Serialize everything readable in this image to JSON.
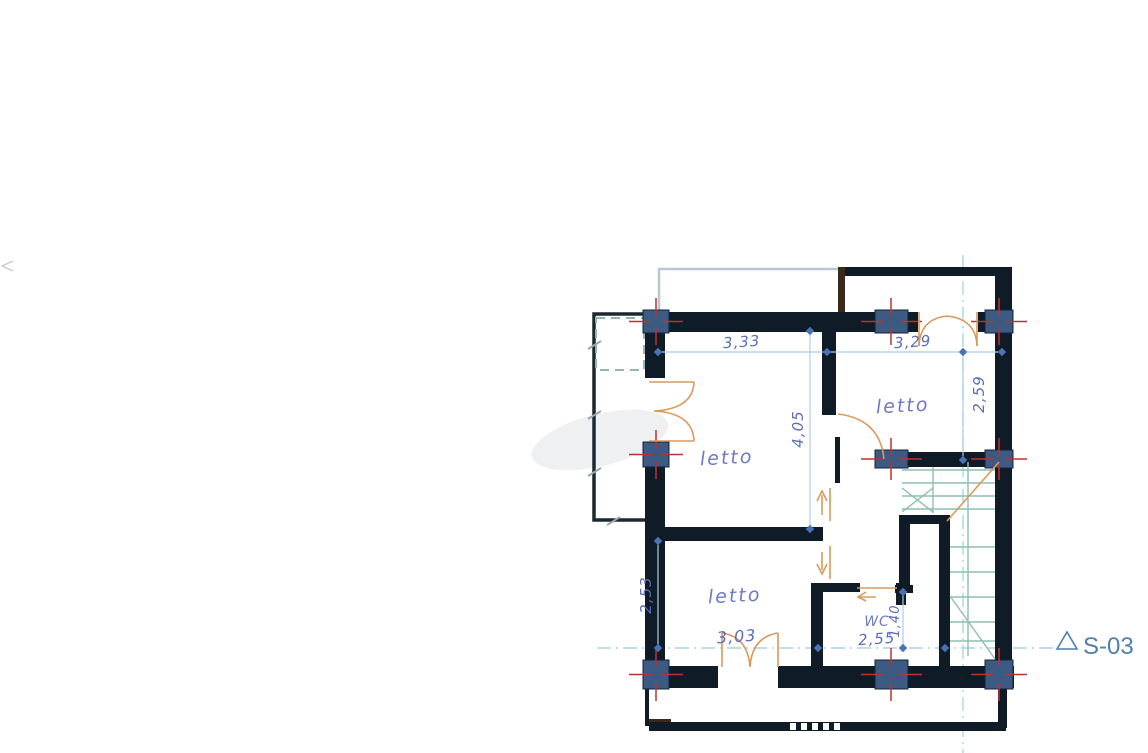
{
  "drawing": {
    "type": "architectural floor plan",
    "language": "Italian"
  },
  "rooms": [
    {
      "name": "bedroom-left",
      "label": "letto"
    },
    {
      "name": "bedroom-right",
      "label": "letto"
    },
    {
      "name": "bedroom-bottom",
      "label": "letto"
    },
    {
      "name": "wc",
      "label": "WC"
    }
  ],
  "dimensions": {
    "top_left_width": "3,33",
    "top_right_width": "3,29",
    "left_room_height": "4,05",
    "right_room_height": "2,59",
    "bottom_room_height": "2,53",
    "bottom_room_width": "3,03",
    "wc_width": "2,55",
    "wc_depth": "1,40"
  },
  "section_marker": {
    "label": "S-03"
  },
  "colors": {
    "background": "#ffffff",
    "wall": "#0f1b26",
    "wood_post": "#3a2a1c",
    "column_fill": "#3c5a82",
    "column_tick_red": "#c03030",
    "dimension_text": "#5b6cb8",
    "dimension_line": "#aacde8",
    "door_swing_orange": "#d99a5b",
    "stair_green": "#8fbfae",
    "centerline_blue": "#a9d4e6",
    "section_marker_blue": "#4f81ab",
    "balcony_dash_teal": "#92b8ae"
  }
}
